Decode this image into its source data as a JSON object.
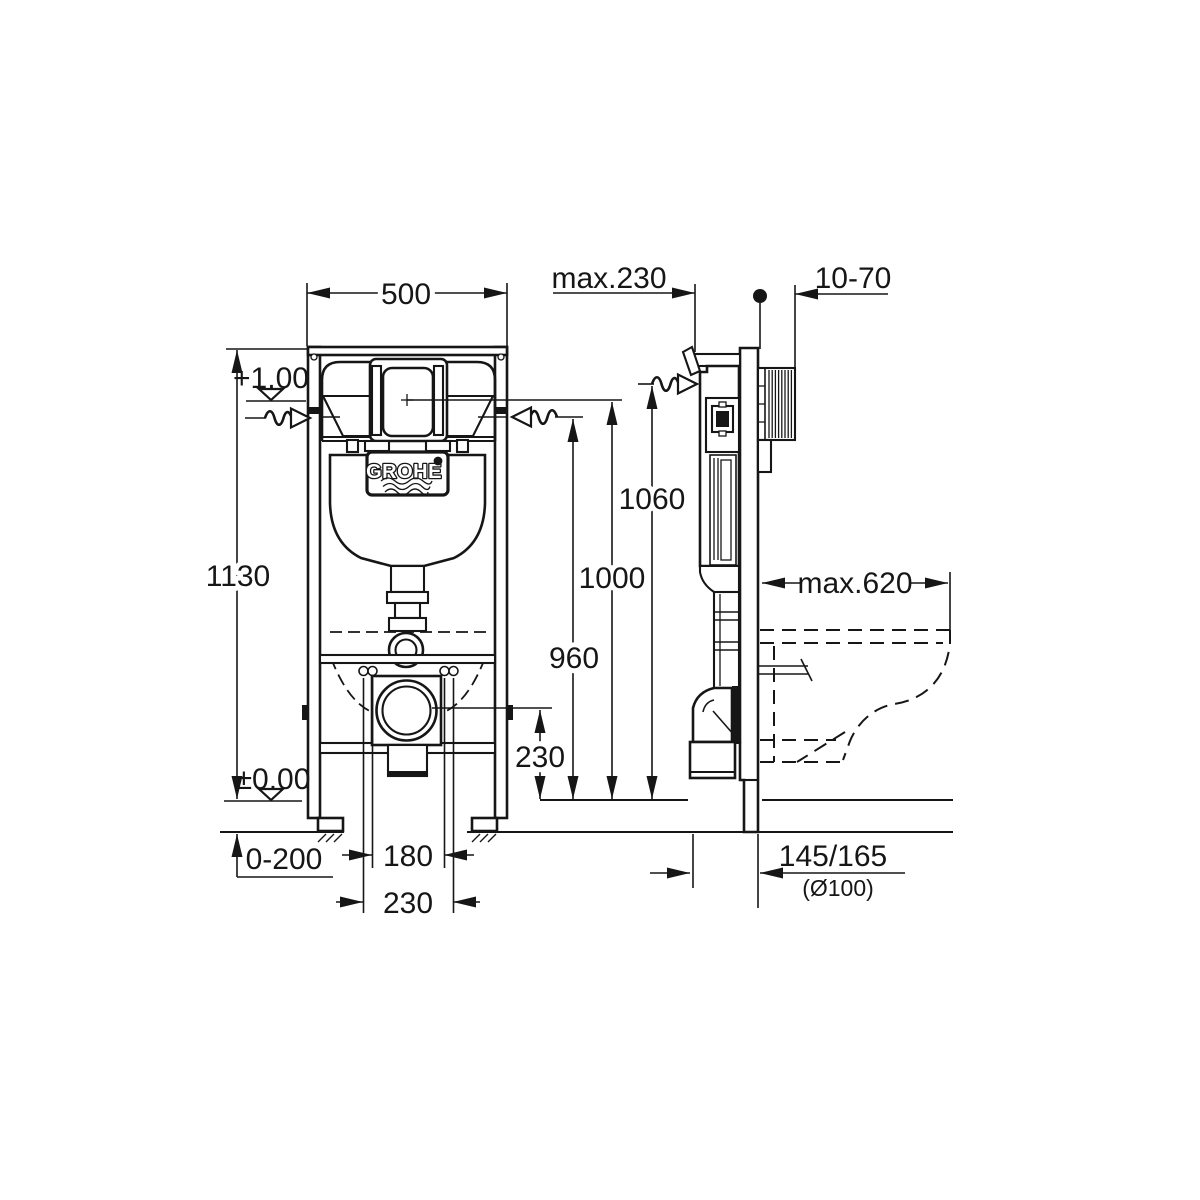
{
  "drawing": {
    "logo": "GROHE",
    "dims": {
      "width500": "500",
      "maxDepth": "max.230",
      "wallRange": "10-70",
      "levelTop": "+1,00",
      "height1130": "1130",
      "levelFloor": "±0,00",
      "h1060": "1060",
      "h1000": "1000",
      "h960": "960",
      "h230": "230",
      "maxPan": "max.620",
      "footAdjust": "0-200",
      "bolt180": "180",
      "bolt230": "230",
      "drainOffset": "145/165",
      "drainDia": "(Ø100)"
    }
  }
}
